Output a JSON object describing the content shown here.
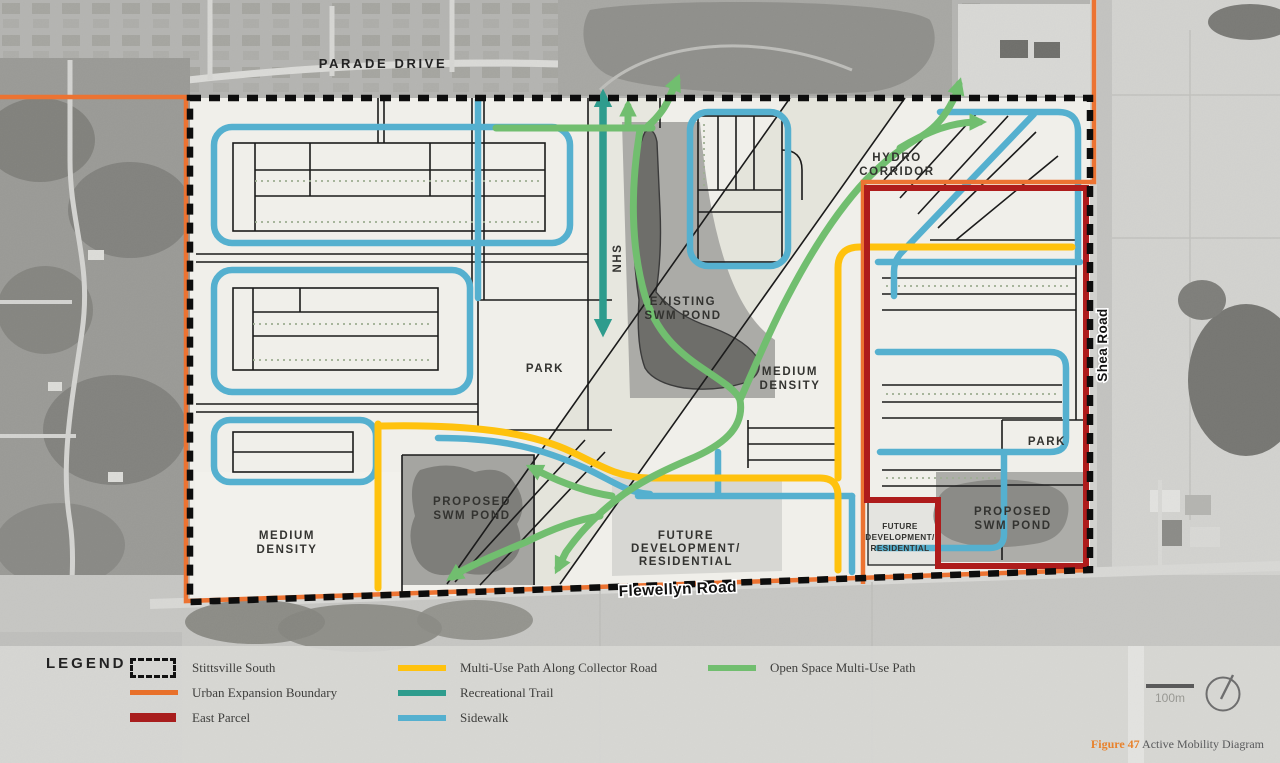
{
  "figure": {
    "caption_figure": "Figure 47",
    "caption_title": " Active Mobility Diagram",
    "scale_label": "100m",
    "compass_icon": "north-arrow-compass"
  },
  "map": {
    "roads": {
      "parade": "PARADE DRIVE",
      "flewellyn": "Flewellyn Road",
      "shea": "Shea Road",
      "nhs": "NHS"
    },
    "labels": {
      "hydro": [
        "HYDRO",
        "CORRIDOR"
      ],
      "existing_swm": [
        "EXISTING",
        "SWM POND"
      ],
      "park_central": "PARK",
      "medium_density_center": [
        "MEDIUM",
        "DENSITY"
      ],
      "medium_density_west": [
        "MEDIUM",
        "DENSITY"
      ],
      "proposed_swm_west": [
        "PROPOSED",
        "SWM POND"
      ],
      "future_dev_center": [
        "FUTURE",
        "DEVELOPMENT/",
        "RESIDENTIAL"
      ],
      "future_dev_east": [
        "FUTURE",
        "DEVELOPMENT/",
        "RESIDENTIAL"
      ],
      "park_east": "PARK",
      "proposed_swm_east": [
        "PROPOSED",
        "SWM POND"
      ]
    }
  },
  "legend": {
    "title": "LEGEND",
    "columns": [
      {
        "items": [
          {
            "label": "Stittsville South",
            "swatch": "dashed-black",
            "color": "#111111"
          },
          {
            "label": "Urban Expansion Boundary",
            "swatch": "line",
            "color": "#E8702A"
          },
          {
            "label": "East Parcel",
            "swatch": "thick-line",
            "color": "#A81D1D"
          }
        ]
      },
      {
        "items": [
          {
            "label": "Multi-Use Path Along Collector Road",
            "swatch": "line",
            "color": "#FFC20E"
          },
          {
            "label": "Recreational Trail",
            "swatch": "line",
            "color": "#2E9C8D"
          },
          {
            "label": "Sidewalk",
            "swatch": "line",
            "color": "#55B0CF"
          }
        ]
      },
      {
        "items": [
          {
            "label": "Open Space Multi-Use Path",
            "swatch": "line",
            "color": "#71BE6F"
          }
        ]
      }
    ]
  }
}
